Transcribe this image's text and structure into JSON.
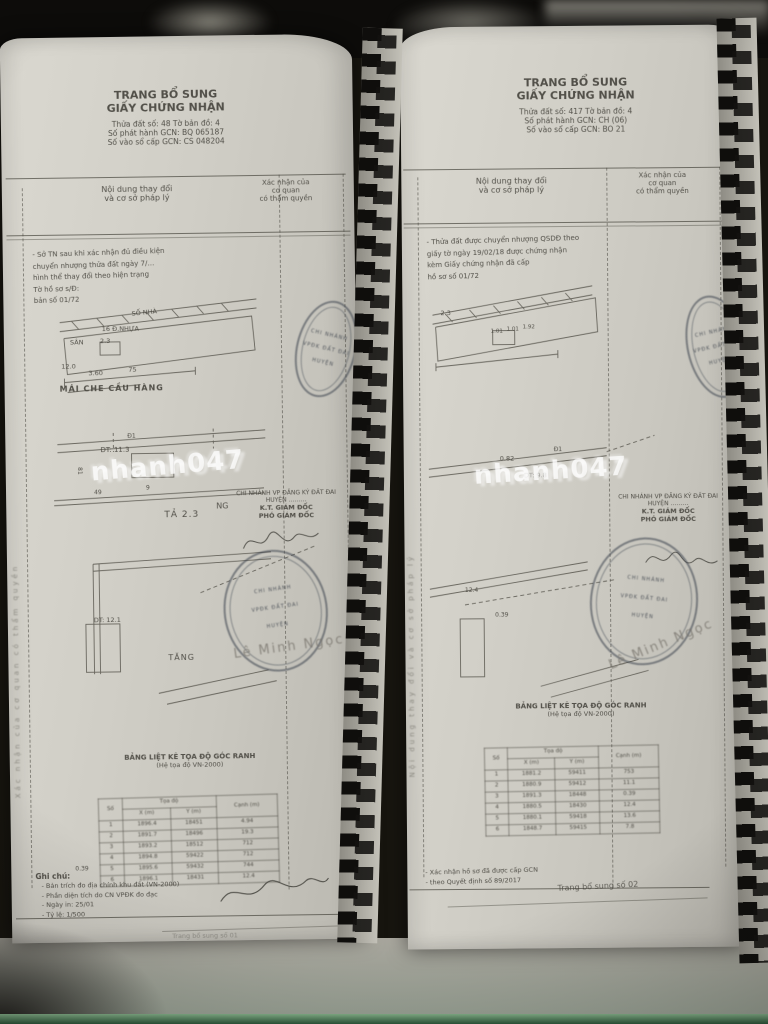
{
  "watermarks": {
    "site": "nhanh047",
    "agent": "Lê Minh Ngọc"
  },
  "columns": {
    "left_l1": "Nội dung thay đổi",
    "left_l2": "và cơ sở pháp lý",
    "right_l1": "Xác nhận của",
    "right_l2": "cơ quan",
    "right_l3": "có thẩm quyền",
    "margin_left": "Xác nhận của cơ quan có thẩm quyền",
    "margin_mid": "Nội dung thay đổi và cơ sở pháp lý"
  },
  "officials": {
    "l1": "CHI NHÁNH VP ĐĂNG KÝ ĐẤT ĐAI",
    "l2": "HUYỆN ………",
    "l3": "K.T. GIÁM ĐỐC",
    "l4": "PHÓ GIÁM ĐỐC"
  },
  "stamp": {
    "l1": "CHI NHÁNH",
    "l2": "VPĐK ĐẤT ĐAI",
    "l3": "HUYỆN"
  },
  "table_meta": {
    "title": "BẢNG LIỆT KÊ TỌA ĐỘ GÓC RANH",
    "subtitle": "(Hệ tọa độ VN-2000)",
    "col_no": "Số",
    "col_coord": "Tọa độ",
    "col_x": "X (m)",
    "col_y": "Y (m)",
    "col_edge": "Cạnh (m)"
  },
  "left_page": {
    "header": {
      "l1": "TRANG BỔ SUNG",
      "l2": "GIẤY CHỨNG NHẬN",
      "l3": "Thửa đất số: 48   Tờ bản đồ: 4",
      "l4": "Số phát hành GCN: BQ 065187",
      "l5": "Số vào sổ cấp GCN: CS 048204"
    },
    "paragraph": {
      "p1": "- Sở TN sau khi xác nhận đủ điều kiện",
      "p2": "chuyển nhượng thửa đất ngày 7/…",
      "p3": "hình thể thay đổi theo hiện trạng",
      "p4": "Tờ hồ sơ s/Đ:",
      "p5": "bản số 01/72"
    },
    "drawing": {
      "so_nha": "SỐ NHÀ",
      "duong": "16 Đ.NHỰA",
      "san": "SÂN",
      "d_23": "2.3",
      "d_120": "12.0",
      "d_360": "3.60",
      "d_75": "75",
      "mai_che": "MÁI CHE CẦU HÀNG",
      "dt1": "DT: 11.3",
      "d1_lbl": "Đ1",
      "d_81": "81",
      "d_49": "49",
      "d_9": "9",
      "ng": "NG",
      "ta": "TẢ 2.3",
      "dt2": "DT: 12.1",
      "tang": "TĂNG",
      "d_039": "0.39"
    },
    "table": {
      "rows": [
        {
          "n": "1",
          "x": "1896.4",
          "y": "18451",
          "c": "4.94"
        },
        {
          "n": "2",
          "x": "1891.7",
          "y": "18496",
          "c": "19.3"
        },
        {
          "n": "3",
          "x": "1893.2",
          "y": "18512",
          "c": "712"
        },
        {
          "n": "4",
          "x": "1894.8",
          "y": "59422",
          "c": "712"
        },
        {
          "n": "5",
          "x": "1895.6",
          "y": "59432",
          "c": "744"
        },
        {
          "n": "6",
          "x": "1896.1",
          "y": "18431",
          "c": "12.4"
        }
      ]
    },
    "notes": {
      "label": "Ghi chú:",
      "n1": "- Bản trích đo địa chính khu đất (VN-2000)",
      "n2": "- Phần diện tích do CN VPĐK đo đạc",
      "n3": "- Ngày in: 25/01",
      "n4": "- Tỷ lệ: 1/500"
    },
    "page_no": "Trang bổ sung số 01"
  },
  "right_page": {
    "header": {
      "l1": "TRANG BỔ SUNG",
      "l2": "GIẤY CHỨNG NHẬN",
      "l3": "Thửa đất số: 417   Tờ bản đồ: 4",
      "l4": "Số phát hành GCN: CH (06)",
      "l5": "Số vào sổ cấp GCN: BO 21"
    },
    "paragraph": {
      "p1": "- Thửa đất được chuyển nhượng QSDĐ theo",
      "p2": "giấy tờ ngày 19/02/18 được chứng nhận",
      "p3": "kèm Giấy chứng nhận đã cấp",
      "p4": "hồ sơ số 01/72"
    },
    "drawing": {
      "d_23": "2.3",
      "d_101a": "1.01",
      "d_101b": "1.01",
      "d_192": "1.92",
      "d_082": "0.82",
      "d1_lbl": "Đ1",
      "dt": "DT: 9.8",
      "d_124": "12.4",
      "d_039": "0.39"
    },
    "table": {
      "rows": [
        {
          "n": "1",
          "x": "1881.2",
          "y": "59411",
          "c": "753"
        },
        {
          "n": "2",
          "x": "1880.9",
          "y": "59412",
          "c": "11.1"
        },
        {
          "n": "3",
          "x": "1891.3",
          "y": "18448",
          "c": "0.39"
        },
        {
          "n": "4",
          "x": "1880.5",
          "y": "18430",
          "c": "12.4"
        },
        {
          "n": "5",
          "x": "1880.1",
          "y": "59418",
          "c": "13.6"
        },
        {
          "n": "6",
          "x": "1848.7",
          "y": "59415",
          "c": "7.8"
        }
      ]
    },
    "notes": {
      "n1": "- Xác nhận hồ sơ đã được cấp GCN",
      "n2": "- theo Quyết định số 89/2017"
    },
    "page_no": "Trang bổ sung số 02"
  }
}
